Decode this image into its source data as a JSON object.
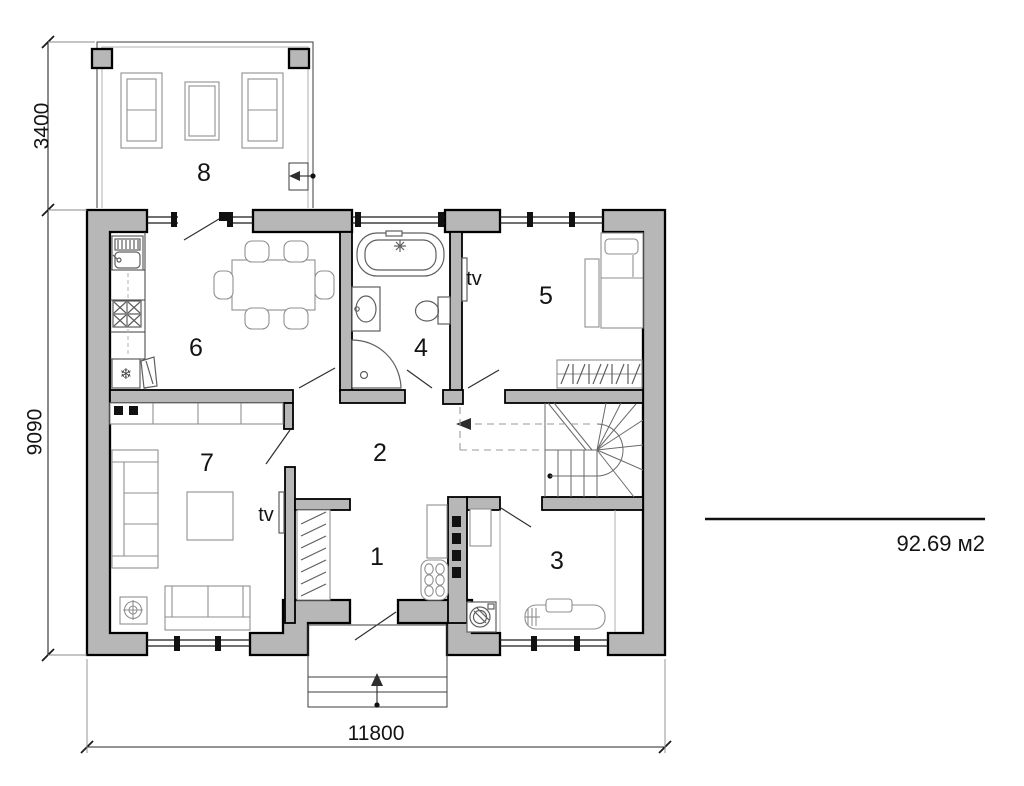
{
  "floor_plan": {
    "rooms": [
      {
        "number": "1"
      },
      {
        "number": "2"
      },
      {
        "number": "3"
      },
      {
        "number": "4"
      },
      {
        "number": "5"
      },
      {
        "number": "6"
      },
      {
        "number": "7"
      },
      {
        "number": "8"
      }
    ],
    "tv_label": "tv",
    "dimensions": {
      "terrace_depth": "3400",
      "house_depth": "9090",
      "house_width": "11800"
    },
    "total_area": "92.69 м2",
    "icons": {
      "fridge_snowflake": "❄"
    },
    "colors": {
      "wall_fill": "#b7b7b7",
      "outline": "#000000",
      "background": "#ffffff"
    }
  }
}
